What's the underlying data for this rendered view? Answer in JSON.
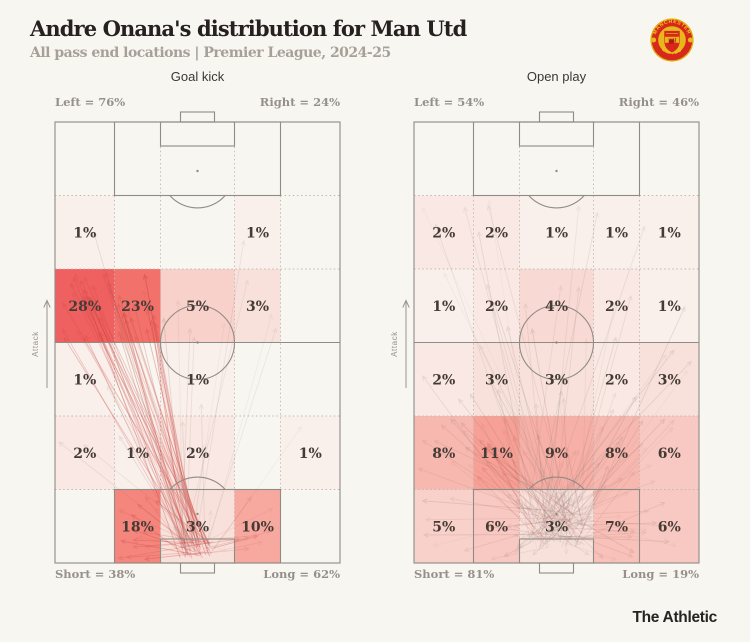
{
  "header": {
    "title": "Andre Onana's distribution for Man Utd",
    "subtitle": "All pass end locations | Premier League, 2024-25"
  },
  "crest": {
    "top_text": "MANCHESTER",
    "bottom_text": "UNITED"
  },
  "footer": {
    "brand": "The Athletic"
  },
  "pitch_annotations": {
    "attack": "Attack"
  },
  "palette": {
    "1": "#f9f0ec",
    "2": "#f9e8e3",
    "3": "#f8e1db",
    "4": "#f8d9d3",
    "5": "#f8d1cb",
    "6": "#f8c9c2",
    "7": "#f8c1b9",
    "8": "#f7b8b0",
    "9": "#f7b0a7",
    "10": "#f7a89f",
    "11": "#f6a096",
    "18": "#f5867d",
    "23": "#f2716b",
    "28": "#ef6060"
  },
  "colors": {
    "background": "#f8f6f1",
    "pitch_line": "#908b85",
    "grid_line": "#c1b9af",
    "cell_text": "#453b35",
    "corner_label": "#97908a",
    "attack": "#9a948c",
    "accent_red": "#ef6060",
    "crest_red": "#d7281d",
    "crest_gold": "#e8b71c"
  },
  "chart_data": [
    {
      "type": "heatmap",
      "title": "Goal kick",
      "layout": "vertical-football-pitch, 5 columns x 5 zone rows, attack pointing up",
      "labels": {
        "top_left": "Left = 76%",
        "top_right": "Right = 24%",
        "bottom_left": "Short = 38%",
        "bottom_right": "Long = 62%"
      },
      "grid": {
        "rows": 5,
        "cols": 5
      },
      "cells": [
        {
          "r": 0,
          "c": 0,
          "v": 1
        },
        {
          "r": 0,
          "c": 3,
          "v": 1
        },
        {
          "r": 1,
          "c": 0,
          "v": 28
        },
        {
          "r": 1,
          "c": 1,
          "v": 23
        },
        {
          "r": 1,
          "c": 2,
          "v": 5
        },
        {
          "r": 1,
          "c": 3,
          "v": 3
        },
        {
          "r": 2,
          "c": 0,
          "v": 1
        },
        {
          "r": 2,
          "c": 2,
          "v": 1
        },
        {
          "r": 3,
          "c": 0,
          "v": 2
        },
        {
          "r": 3,
          "c": 1,
          "v": 1
        },
        {
          "r": 3,
          "c": 2,
          "v": 2
        },
        {
          "r": 3,
          "c": 4,
          "v": 1
        },
        {
          "r": 4,
          "c": 1,
          "v": 18
        },
        {
          "r": 4,
          "c": 2,
          "v": 3
        },
        {
          "r": 4,
          "c": 3,
          "v": 10
        }
      ]
    },
    {
      "type": "heatmap",
      "title": "Open play",
      "layout": "vertical-football-pitch, 5 columns x 5 zone rows, attack pointing up",
      "labels": {
        "top_left": "Left = 54%",
        "top_right": "Right = 46%",
        "bottom_left": "Short = 81%",
        "bottom_right": "Long = 19%"
      },
      "grid": {
        "rows": 5,
        "cols": 5
      },
      "cells": [
        {
          "r": 0,
          "c": 0,
          "v": 2
        },
        {
          "r": 0,
          "c": 1,
          "v": 2
        },
        {
          "r": 0,
          "c": 2,
          "v": 1
        },
        {
          "r": 0,
          "c": 3,
          "v": 1
        },
        {
          "r": 0,
          "c": 4,
          "v": 1
        },
        {
          "r": 1,
          "c": 0,
          "v": 1
        },
        {
          "r": 1,
          "c": 1,
          "v": 2
        },
        {
          "r": 1,
          "c": 2,
          "v": 4
        },
        {
          "r": 1,
          "c": 3,
          "v": 2
        },
        {
          "r": 1,
          "c": 4,
          "v": 1
        },
        {
          "r": 2,
          "c": 0,
          "v": 2
        },
        {
          "r": 2,
          "c": 1,
          "v": 3
        },
        {
          "r": 2,
          "c": 2,
          "v": 3
        },
        {
          "r": 2,
          "c": 3,
          "v": 2
        },
        {
          "r": 2,
          "c": 4,
          "v": 3
        },
        {
          "r": 3,
          "c": 0,
          "v": 8
        },
        {
          "r": 3,
          "c": 1,
          "v": 11
        },
        {
          "r": 3,
          "c": 2,
          "v": 9
        },
        {
          "r": 3,
          "c": 3,
          "v": 8
        },
        {
          "r": 3,
          "c": 4,
          "v": 6
        },
        {
          "r": 4,
          "c": 0,
          "v": 5
        },
        {
          "r": 4,
          "c": 1,
          "v": 6
        },
        {
          "r": 4,
          "c": 2,
          "v": 3
        },
        {
          "r": 4,
          "c": 3,
          "v": 7
        },
        {
          "r": 4,
          "c": 4,
          "v": 6
        }
      ]
    }
  ]
}
